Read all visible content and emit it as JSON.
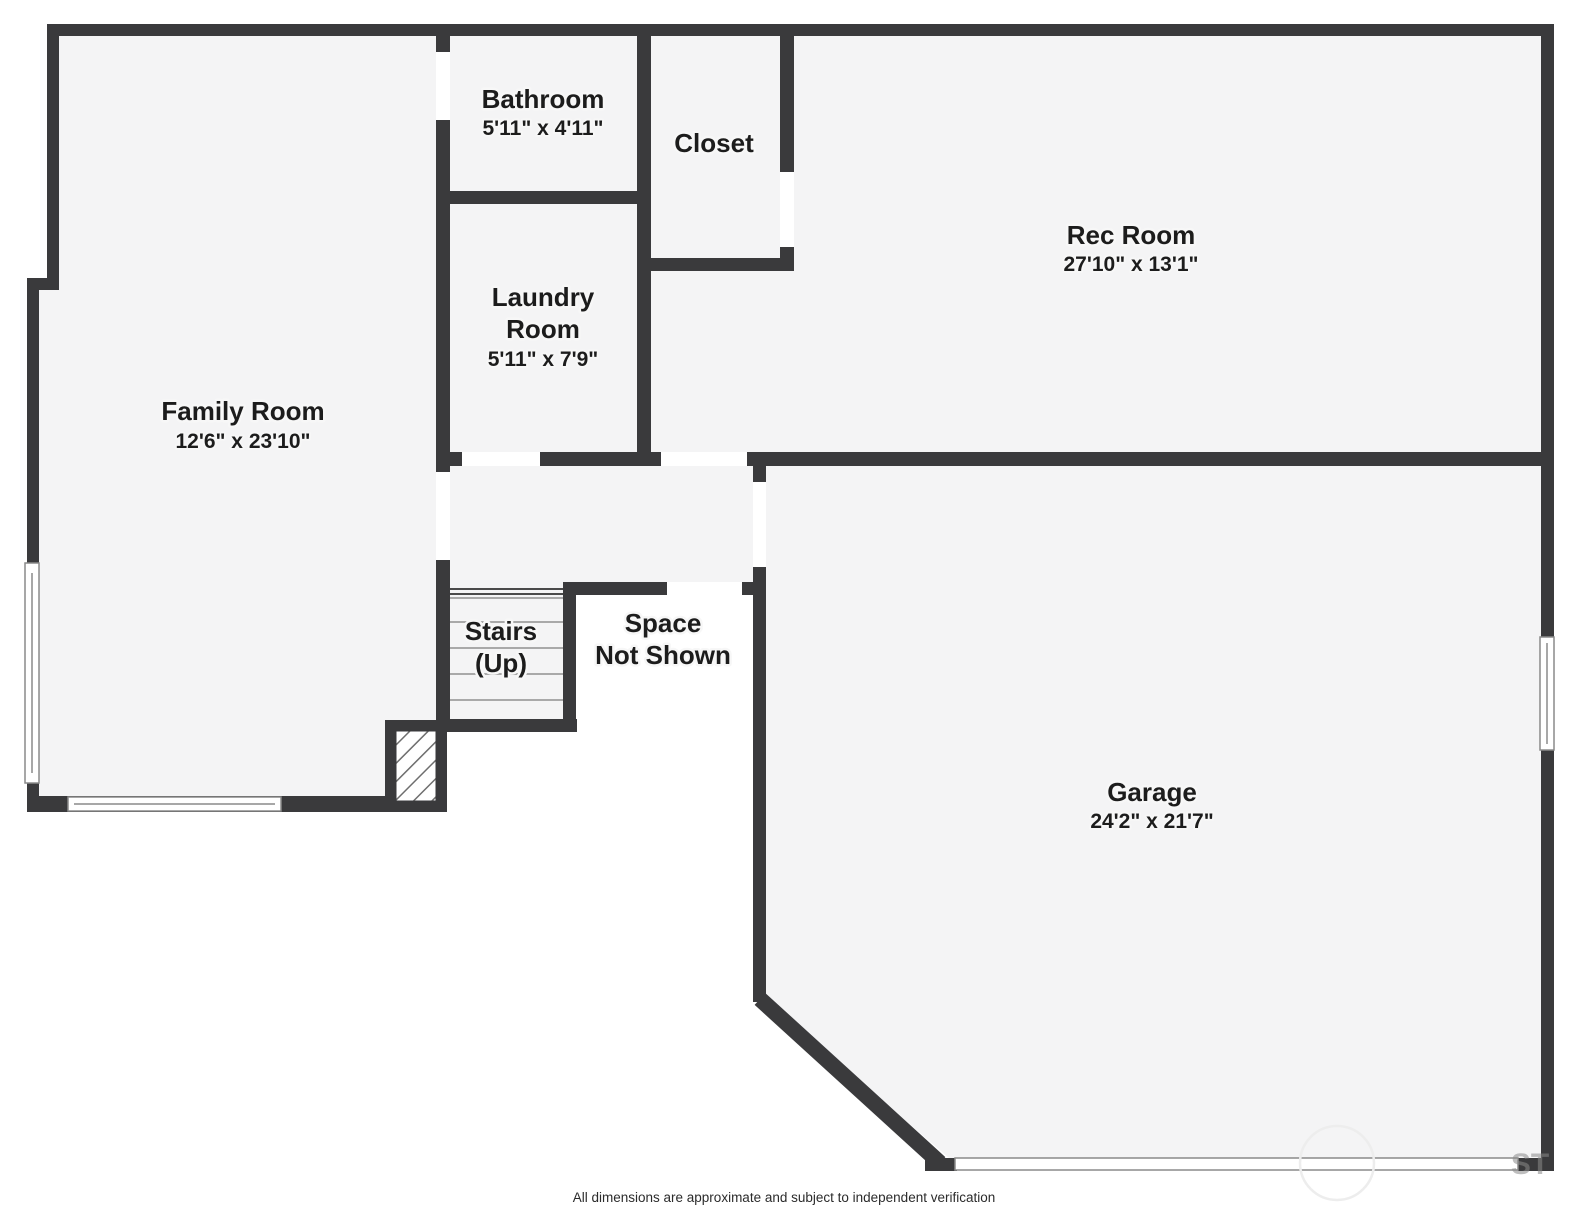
{
  "plan": {
    "rooms": {
      "bathroom": {
        "name": "Bathroom",
        "dims": "5'11\" x 4'11\""
      },
      "closet": {
        "name": "Closet"
      },
      "rec_room": {
        "name": "Rec Room",
        "dims": "27'10\" x 13'1\""
      },
      "laundry": {
        "name_line1": "Laundry",
        "name_line2": "Room",
        "dims": "5'11\" x 7'9\""
      },
      "family_room": {
        "name": "Family Room",
        "dims": "12'6\" x 23'10\""
      },
      "stairs": {
        "name_line1": "Stairs",
        "name_line2": "(Up)"
      },
      "space_not_shown": {
        "line1": "Space",
        "line2": "Not Shown"
      },
      "garage": {
        "name": "Garage",
        "dims": "24'2\" x 21'7\""
      }
    },
    "footer": {
      "disclaimer": "All dimensions are approximate and subject to independent verification"
    },
    "watermark": {
      "visible_letters": "ST"
    },
    "colors": {
      "wall": "#3a3a3c",
      "room_fill": "#f4f4f5",
      "background": "#ffffff",
      "label_text": "#1c1c1c"
    }
  }
}
